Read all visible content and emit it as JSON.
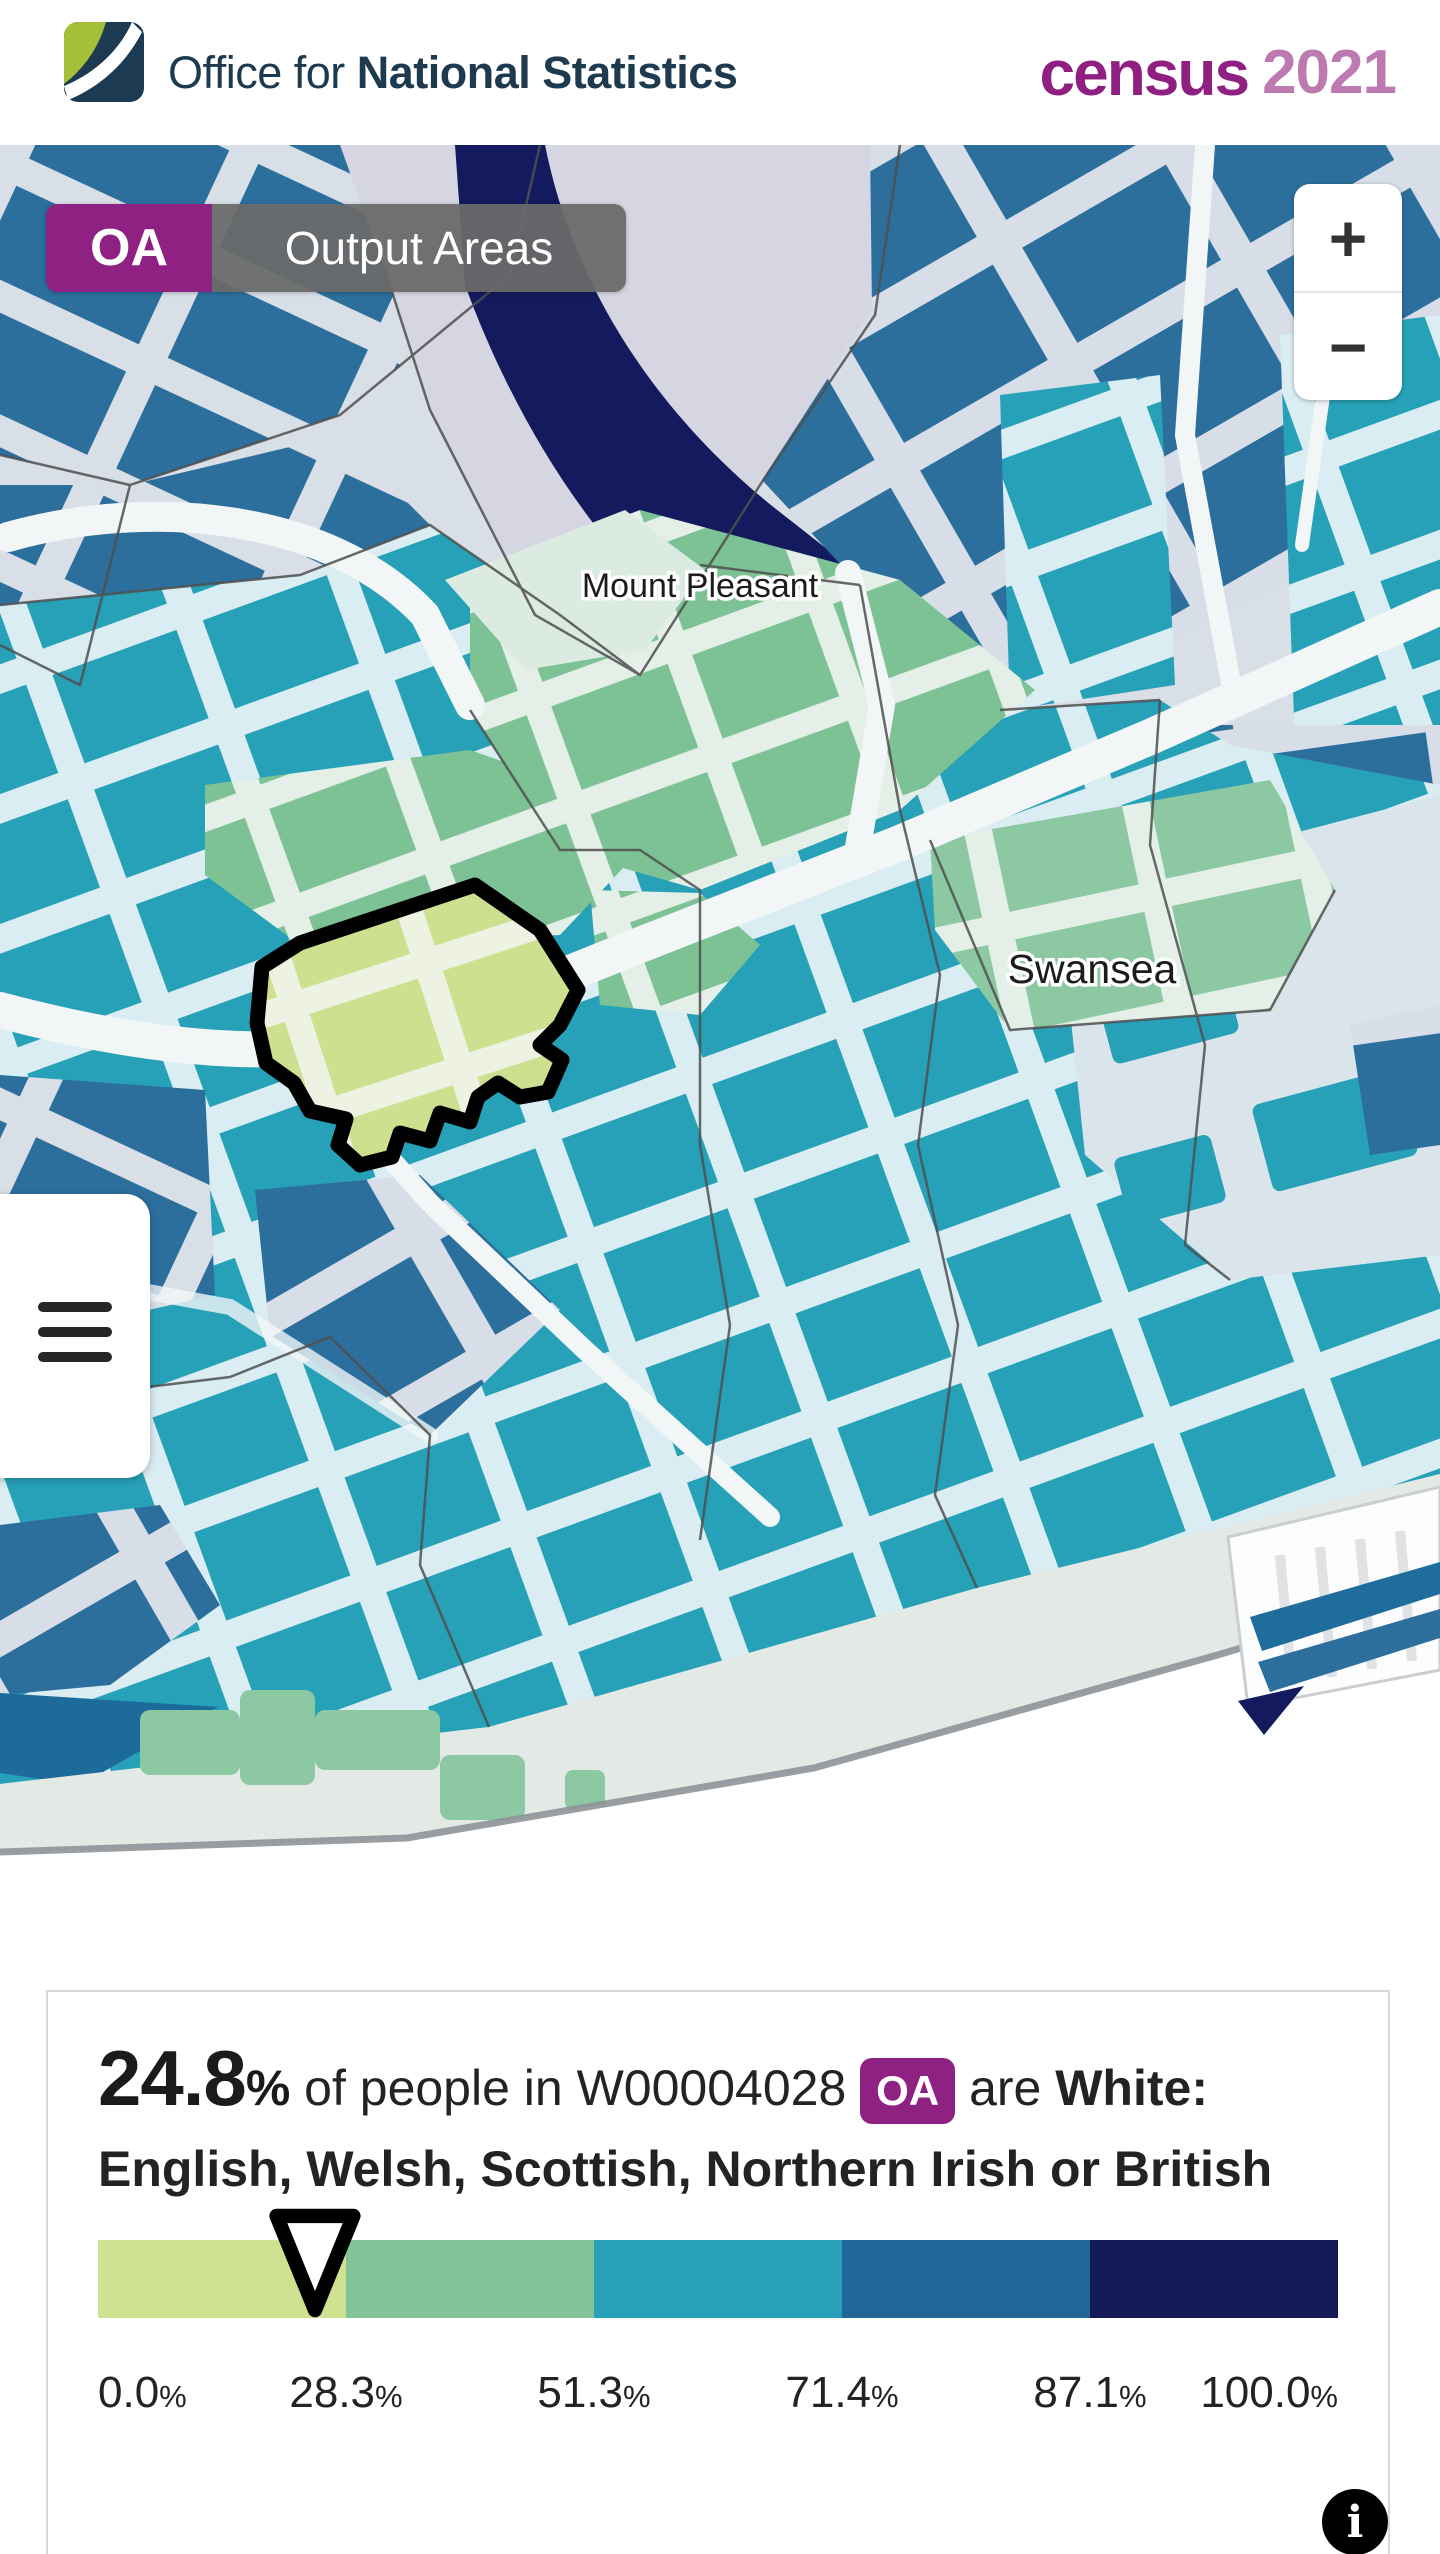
{
  "header": {
    "org_name_regular": "Office for ",
    "org_name_bold": "National Statistics",
    "census_word": "census",
    "census_year": "2021",
    "colors": {
      "org_text": "#1e3a4f",
      "census_word": "#8f2082",
      "census_year": "#bd7ab1"
    }
  },
  "map": {
    "layer_chip": {
      "code": "OA",
      "label": "Output Areas",
      "code_bg": "#8e2181",
      "label_bg": "#6c6c6c"
    },
    "zoom_controls": {
      "zoom_in": "+",
      "zoom_out": "−"
    },
    "place_labels": {
      "mount_pleasant": "Mount Pleasant",
      "swansea": "Swansea"
    },
    "menu_icon": "hamburger-icon",
    "highlight_outline_color": "#000000"
  },
  "info_panel": {
    "headline": {
      "value": "24.8",
      "percent_sign": "%",
      "prefix": " of people in ",
      "area_code": "W00004028",
      "area_badge": "OA",
      "middle": " are ",
      "category": "White: English, Welsh, Scottish, Northern Irish or British"
    },
    "legend": {
      "values": [
        "0.0",
        "28.3",
        "51.3",
        "71.4",
        "87.1",
        "100.0"
      ],
      "percent_sign": "%",
      "stops_pct": [
        0.0,
        28.3,
        51.3,
        71.4,
        87.1,
        100.0
      ],
      "colors": [
        "#cfe292",
        "#84c398",
        "#27a0b8",
        "#1e6797",
        "#131a56"
      ],
      "marker_value_pct": 24.8,
      "marker_fraction": 0.175
    },
    "info_icon": "i"
  }
}
